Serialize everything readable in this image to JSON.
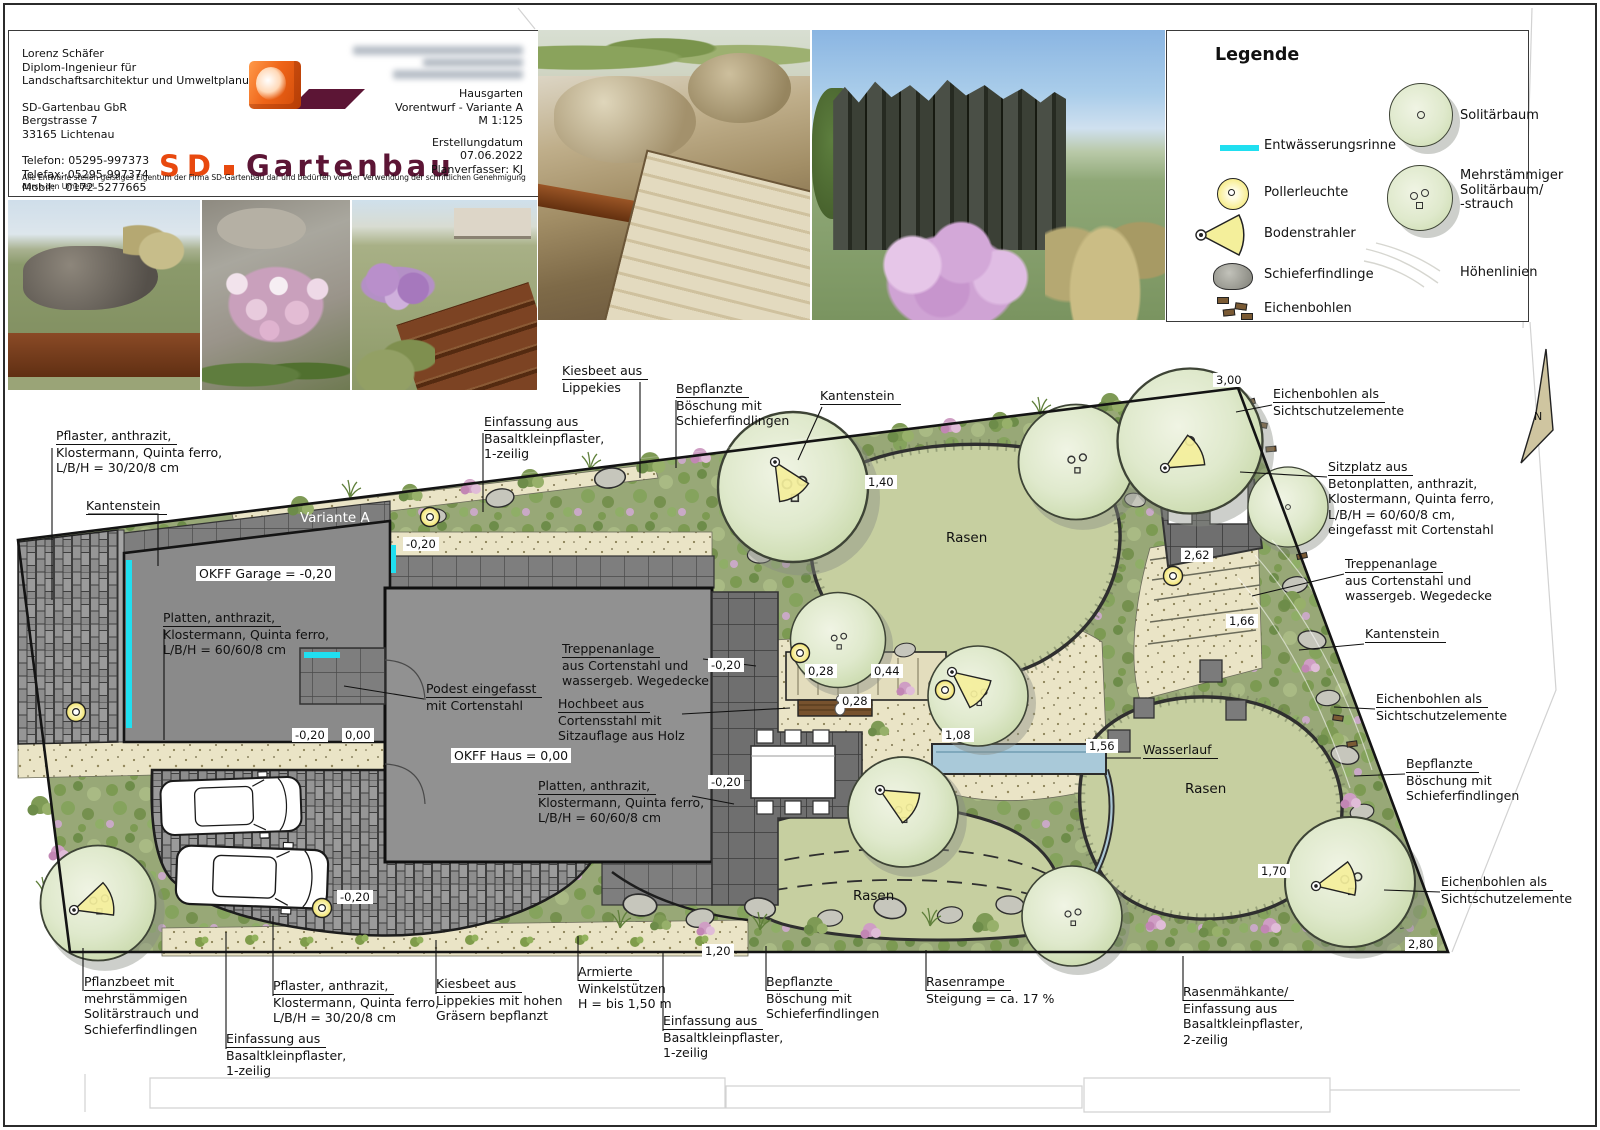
{
  "title_block": {
    "author_lines": [
      "Lorenz Schäfer",
      "Diplom-Ingenieur für",
      "Landschaftsarchitektur und Umweltplanung"
    ],
    "company_lines": [
      "SD-Gartenbau GbR",
      "Bergstrasse 7",
      "33165 Lichtenau"
    ],
    "contact_lines": [
      "Telefon: 05295-997373",
      "Telefax: 05295-997374",
      "Mobil:   0172-5277665"
    ],
    "logo": {
      "sd": "SD",
      "name": "Gartenbau"
    },
    "project_lines": [
      "Hausgarten",
      "Vorentwurf - Variante A",
      "M 1:125"
    ],
    "meta_lines": [
      "Erstellungdatum",
      "07.06.2022",
      "Planverfasser: KJ"
    ],
    "copyright": "Alle Entwürfe stellen geistiges Eigentum der Firma SD-Gartenbau dar und bedürfen vor der Verwendung der schriftlichen Genehmigung durch den Urheber!"
  },
  "legend": {
    "title": "Legende",
    "entwaesserungsrinne": "Entwässerungsrinne",
    "pollerleuchte": "Pollerleuchte",
    "bodenstrahler": "Bodenstrahler",
    "schieferfindlinge": "Schieferfindlinge",
    "eichenbohlen": "Eichenbohlen",
    "solitaerbaum": "Solitärbaum",
    "mehrstaemmiger": "Mehrstämmiger\nSolitärbaum/\n-strauch",
    "hoehenlinien": "Höhenlinien"
  },
  "plan": {
    "variant": "Variante A",
    "levels": {
      "garage": "OKFF Garage = -0,20",
      "haus": "OKFF Haus = 0,00"
    },
    "areas": {
      "rasen": "Rasen"
    },
    "north": "N",
    "measurements": [
      "3,00",
      "1,40",
      "2,62",
      "1,66",
      "-0,20",
      "-0,20",
      "0,00",
      "-0,20",
      "-0,20",
      "-0,20",
      "0,28",
      "0,44",
      "0,28",
      "1,08",
      "1,56",
      "1,70",
      "2,80",
      "1,20"
    ],
    "callouts": [
      {
        "t": "Pflaster, anthrazit,",
        "r": "Klostermann, Quinta ferro,\nL/B/H = 30/20/8 cm"
      },
      {
        "t": "Kantenstein",
        "r": ""
      },
      {
        "t": "Einfassung aus",
        "r": "Basaltkleinpflaster,\n1-zeilig"
      },
      {
        "t": "Kiesbeet aus",
        "r": "Lippekies"
      },
      {
        "t": "Bepflanzte",
        "r": "Böschung mit\nSchieferfindlingen"
      },
      {
        "t": "Kantenstein",
        "r": ""
      },
      {
        "t": "Eichenbohlen als",
        "r": "Sichtschutzelemente"
      },
      {
        "t": "Sitzplatz aus",
        "r": "Betonplatten, anthrazit,\nKlostermann, Quinta ferro,\nL/B/H = 60/60/8 cm,\neingefasst mit Cortenstahl"
      },
      {
        "t": "Treppenanlage",
        "r": "aus Cortenstahl und\nwassergeb. Wegedecke"
      },
      {
        "t": "Kantenstein",
        "r": ""
      },
      {
        "t": "Eichenbohlen als",
        "r": "Sichtschutzelemente"
      },
      {
        "t": "Bepflanzte",
        "r": "Böschung mit\nSchieferfindlingen"
      },
      {
        "t": "Eichenbohlen als",
        "r": "Sichtschutzelemente"
      },
      {
        "t": "Pflanzbeet mit",
        "r": "mehrstämmigen\nSolitärstrauch und\nSchieferfindlingen"
      },
      {
        "t": "Einfassung aus",
        "r": "Basaltkleinpflaster,\n1-zeilig"
      },
      {
        "t": "Pflaster, anthrazit,",
        "r": "Klostermann, Quinta ferro,\nL/B/H = 30/20/8 cm"
      },
      {
        "t": "Kiesbeet aus",
        "r": "Lippekies mit hohen\nGräsern bepflanzt"
      },
      {
        "t": "Armierte",
        "r": "Winkelstützen\nH = bis 1,50 m"
      },
      {
        "t": "Einfassung aus",
        "r": "Basaltkleinpflaster,\n1-zeilig"
      },
      {
        "t": "Bepflanzte",
        "r": "Böschung mit\nSchieferfindlingen"
      },
      {
        "t": "Rasenrampe",
        "r": "Steigung = ca. 17 %"
      },
      {
        "t": "Rasenmähkante/",
        "r": "Einfassung aus\nBasaltkleinpflaster,\n2-zeilig"
      },
      {
        "t": "Podest eingefasst",
        "r": "mit Cortenstahl"
      },
      {
        "t": "Treppenanlage",
        "r": "aus Cortenstahl und\nwassergeb. Wegedecke"
      },
      {
        "t": "Hochbeet aus",
        "r": "Cortensstahl mit\nSitzauflage aus Holz"
      },
      {
        "t": "Platten, anthrazit,",
        "r": "Klostermann, Quinta ferro,\nL/B/H = 60/60/8 cm"
      },
      {
        "t": "Platten, anthrazit,",
        "r": "Klostermann, Quinta ferro,\nL/B/H = 60/60/8 cm"
      },
      {
        "t": "Wasserlauf",
        "r": ""
      }
    ]
  },
  "colors": {
    "accent_cyan": "#20dff0",
    "brand_orange": "#e8490f",
    "brand_purple": "#5c1535",
    "lawn_green": "#c6cfa0",
    "border_green": "#98a877",
    "paving_gray": "#8a8a8a",
    "sand_beige": "#eae4c6",
    "light_yellow": "#f4ef9b",
    "corten": "#8a4a26"
  }
}
